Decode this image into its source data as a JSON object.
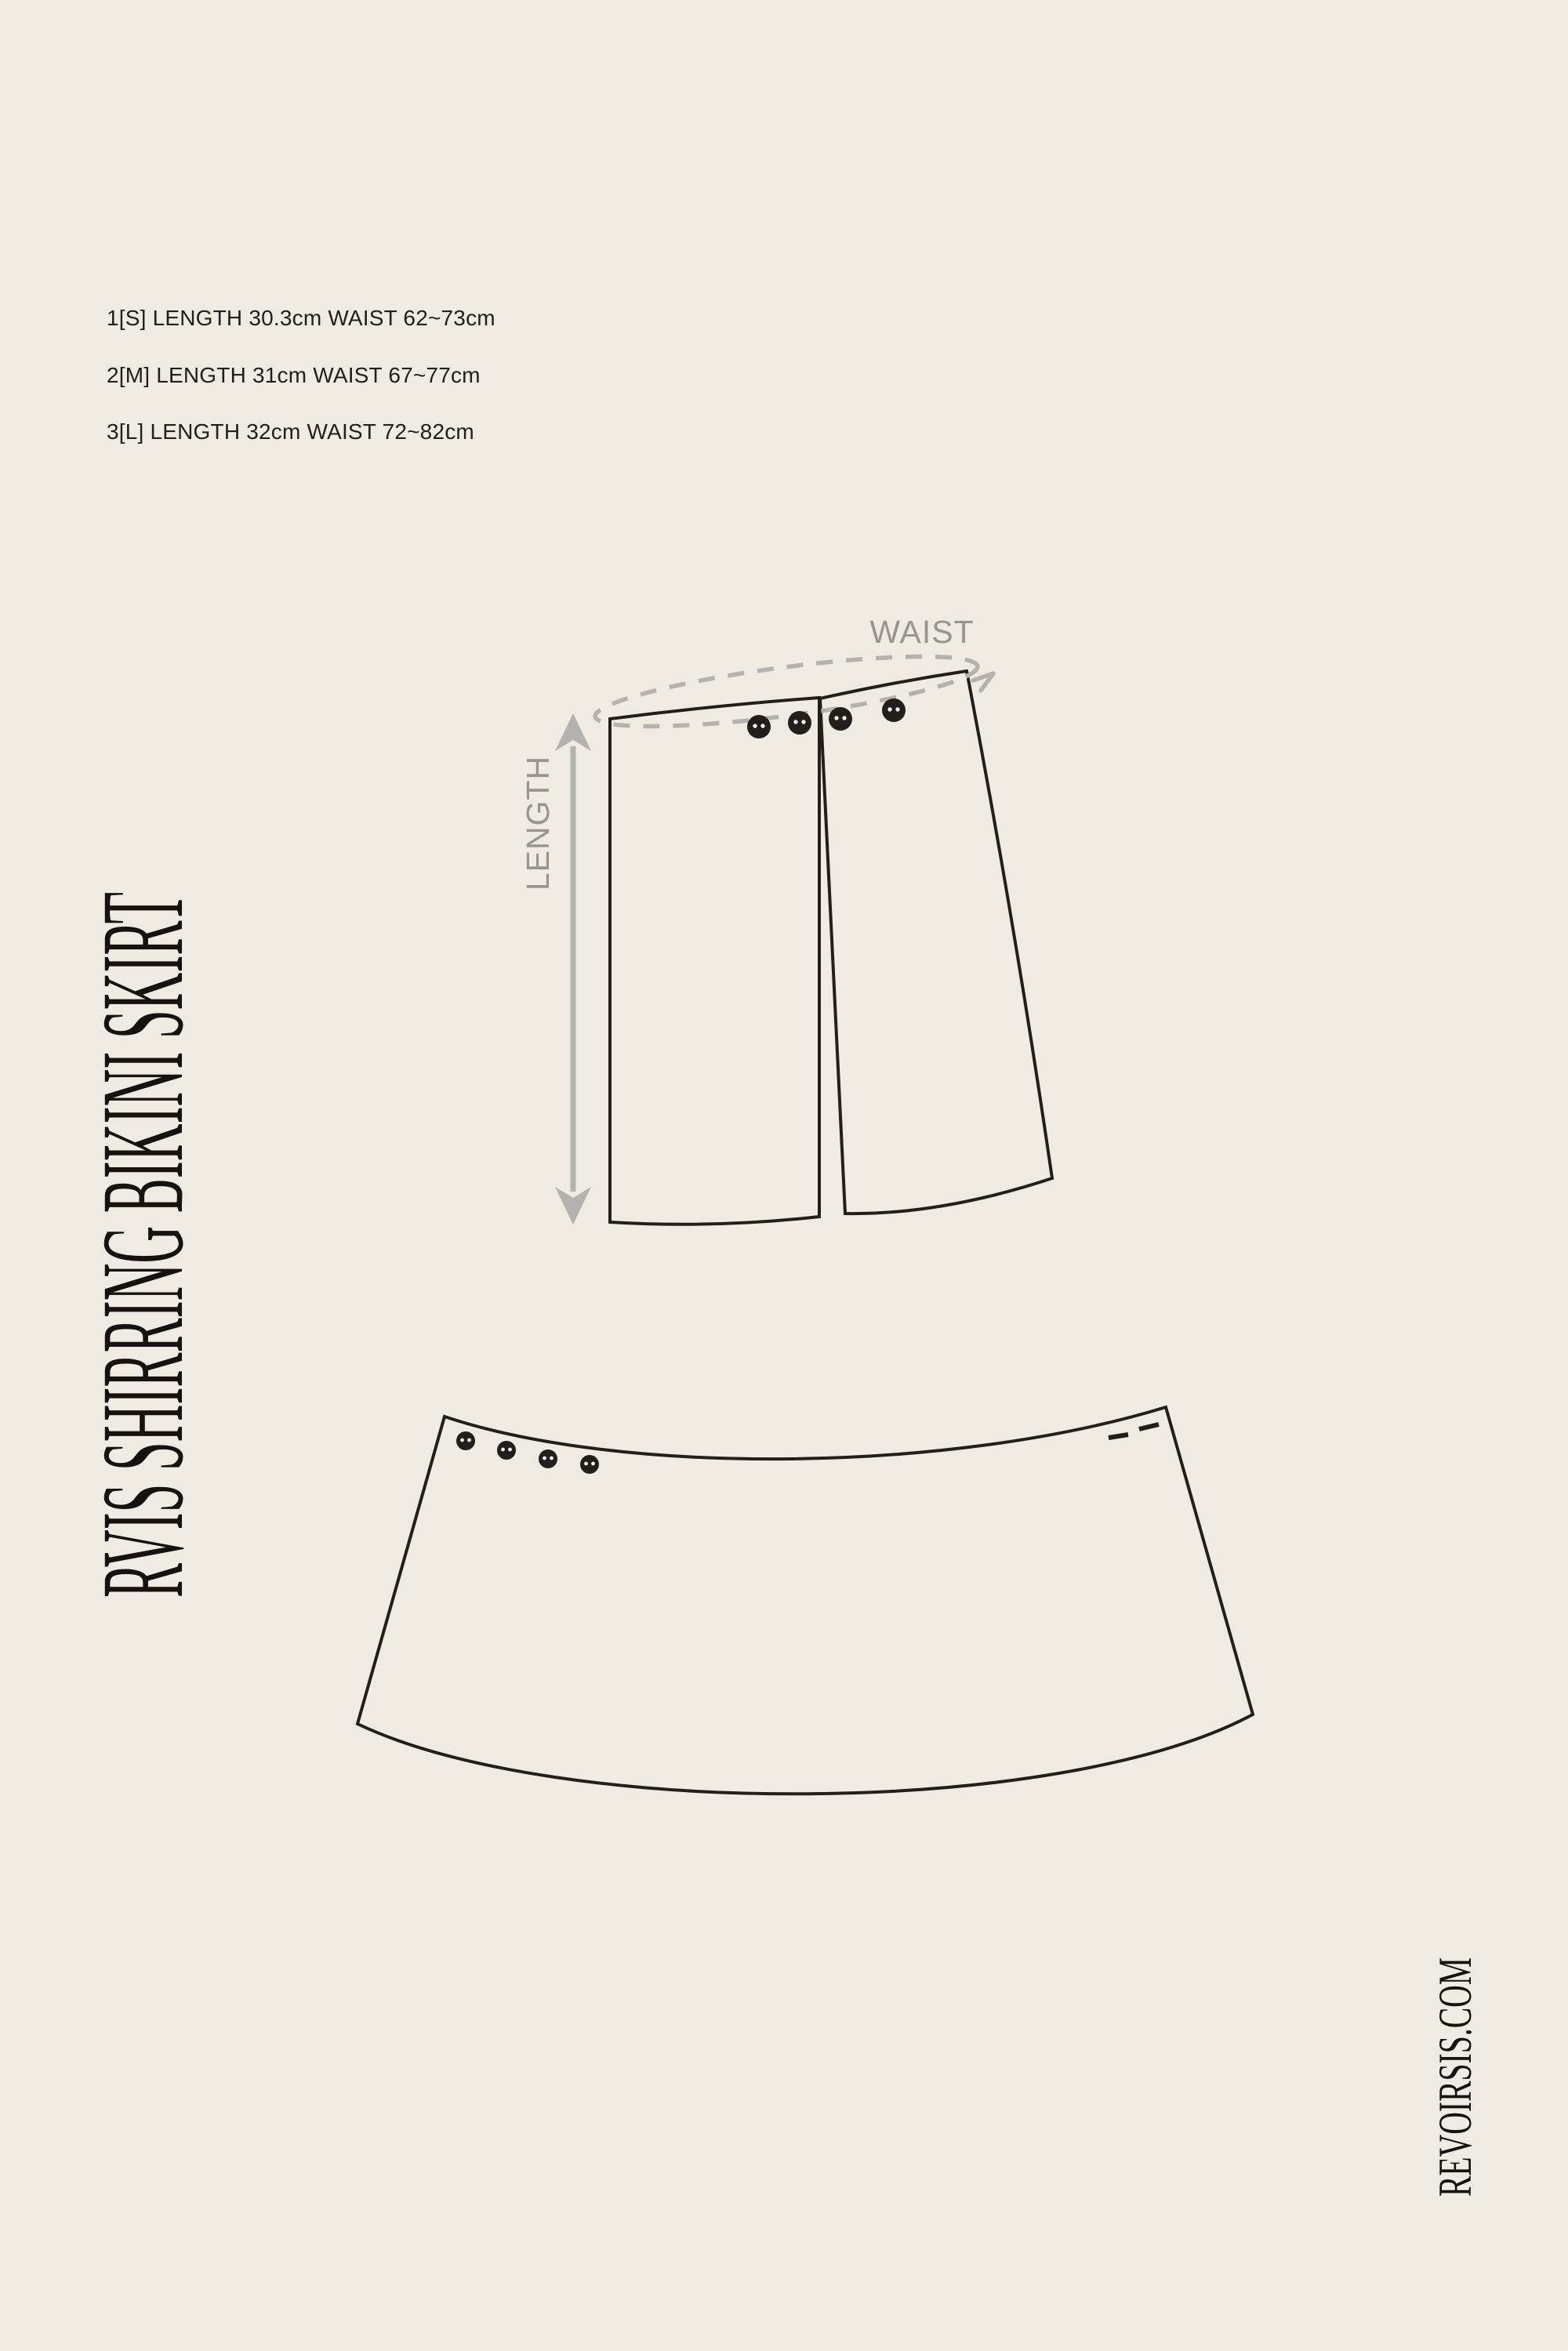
{
  "page": {
    "background": "#EEEBE2",
    "line_color": "#221F1B",
    "gray": "#B3B2AE",
    "label_gray": "#97958D",
    "text_color": "#21201E"
  },
  "size_chart": {
    "lines": [
      "1[S] LENGTH 30.3cm WAIST 62~73cm",
      "2[M] LENGTH 31cm WAIST 67~77cm",
      "3[L] LENGTH 32cm WAIST 72~82cm"
    ]
  },
  "product_title": "RVIS SHIRRING BIKINI SKIRT",
  "website": "REVOIRSIS.COM",
  "diagram": {
    "waist_label": "WAIST",
    "length_label": "LENGTH"
  }
}
